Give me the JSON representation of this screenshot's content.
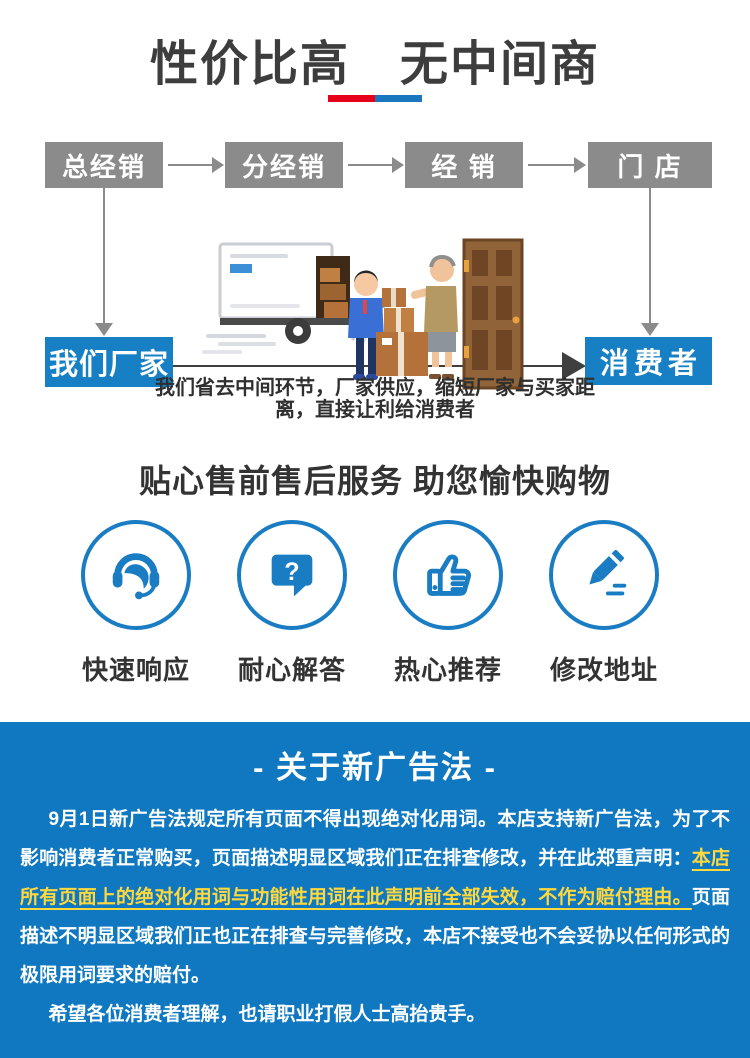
{
  "colors": {
    "accent_red": "#e60019",
    "accent_blue": "#1b76c0",
    "flow_box_gray": "#8b8b8b",
    "brand_blue": "#1780c4",
    "circle_blue": "#1a7cc2",
    "notice_bg_blue": "#0f78c1",
    "highlight_yellow": "#ffd83d"
  },
  "hero": {
    "title": "性价比高　无中间商"
  },
  "flow": {
    "top_boxes": [
      {
        "label": "总经销"
      },
      {
        "label": "分经销"
      },
      {
        "label": "经 销"
      },
      {
        "label": "门 店"
      }
    ],
    "left_box_label": "我们厂家",
    "right_box_label": "消费者",
    "caption_line1": "我们省去中间环节，厂家供应，缩短厂家与买家距",
    "caption_line2": "离，直接让利给消费者",
    "illustration": "delivery-truck-courier-handing-boxes-to-customer-at-door"
  },
  "services": {
    "title": "贴心售前售后服务 助您愉快购物",
    "items": [
      {
        "icon": "headset-icon",
        "label": "快速响应"
      },
      {
        "icon": "question-bubble-icon",
        "label": "耐心解答"
      },
      {
        "icon": "thumbs-up-icon",
        "label": "热心推荐"
      },
      {
        "icon": "pencil-icon",
        "label": "修改地址"
      }
    ]
  },
  "notice": {
    "title": "- 关于新广告法 -",
    "p1_normal1": "9月1日新广告法规定所有页面不得出现绝对化用词。本店支持新广告法，为了不影响消费者正常购买，页面描述明显区域我们正在排查修改，并在此郑重声明：",
    "p1_highlight": "本店所有页面上的绝对化用词与功能性用词在此声明前全部失效，不作为赔付理由。",
    "p1_normal2": "页面描述不明显区域我们正也正在排查与完善修改，本店不接受也不会妥协以任何形式的极限用词要求的赔付。",
    "p2": "希望各位消费者理解，也请职业打假人士高抬贵手。"
  }
}
